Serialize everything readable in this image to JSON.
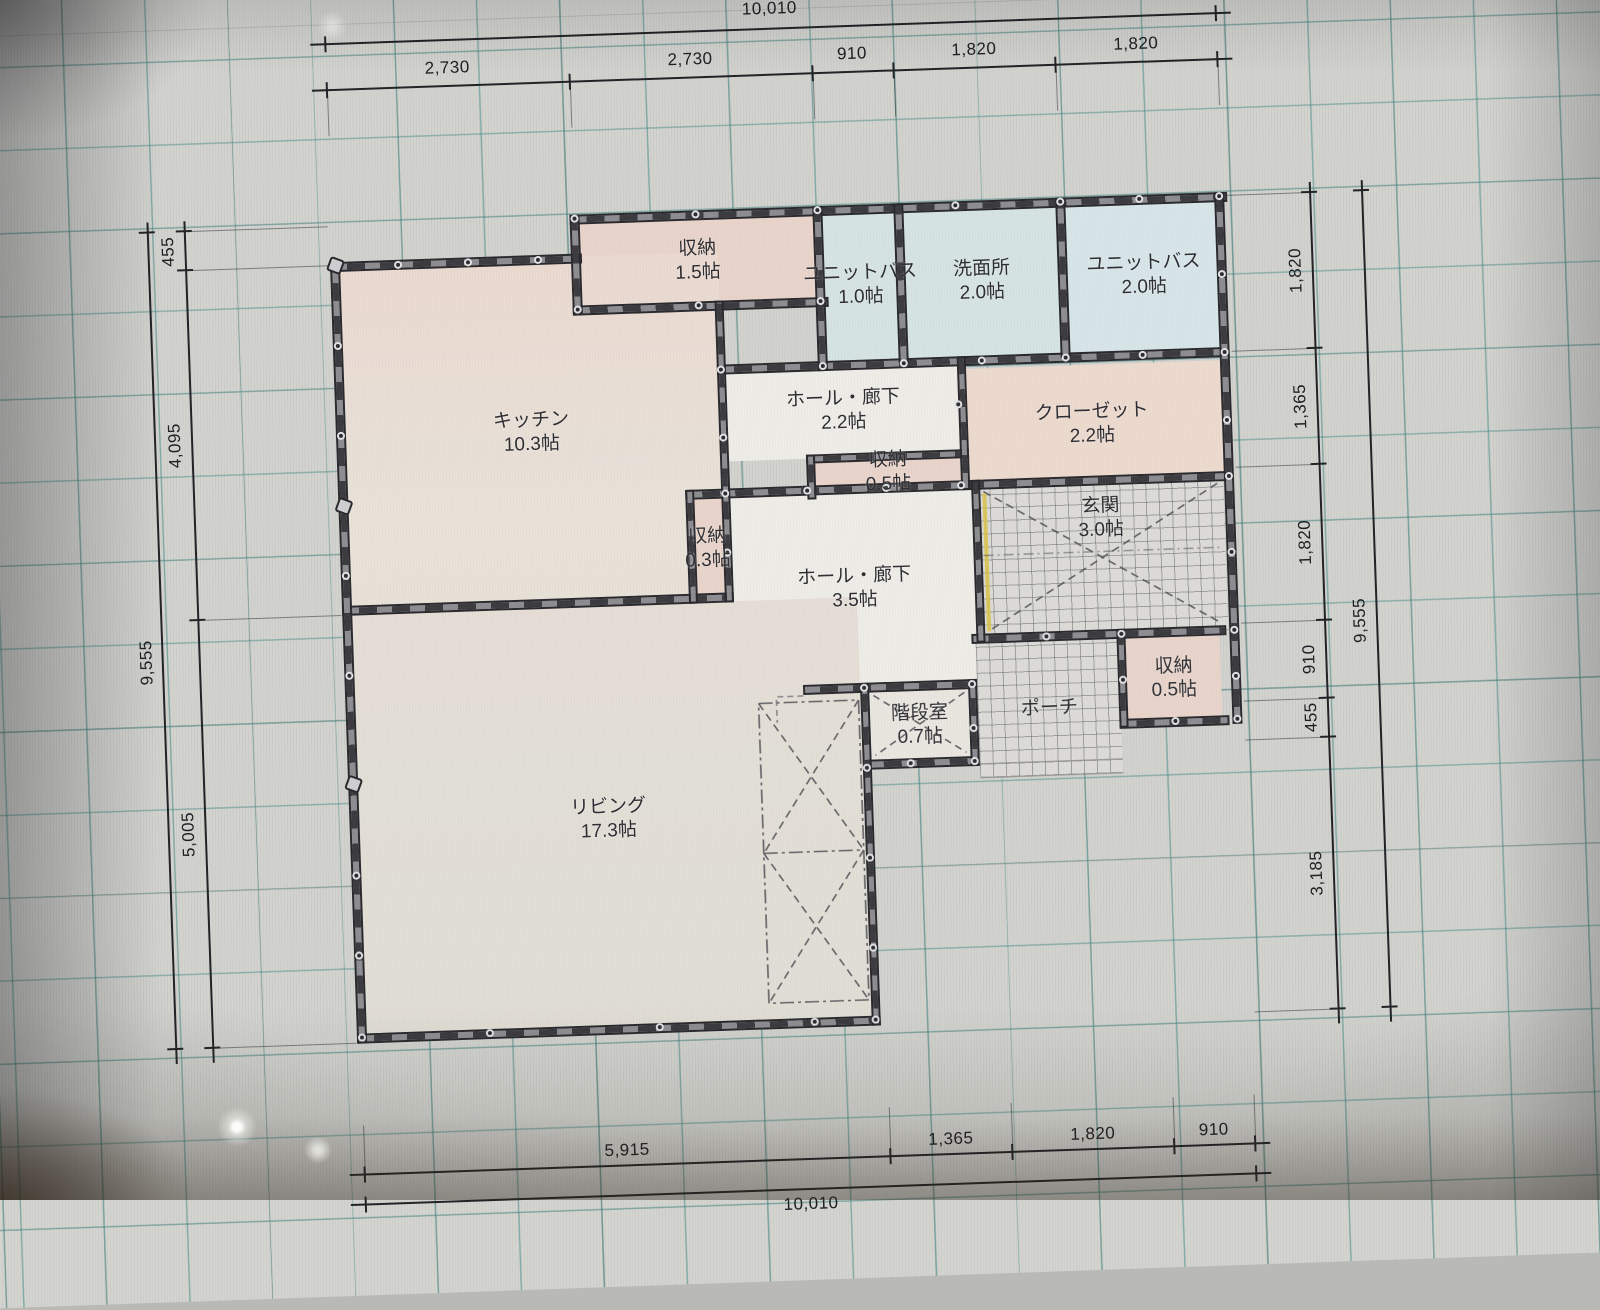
{
  "plan": {
    "title": "floor-plan-cad-canvas",
    "unit_note": "帖",
    "rooms": [
      {
        "id": "storage-1-5",
        "name": "収納",
        "size": "1.5帖"
      },
      {
        "id": "unit-bath-1-0",
        "name": "ユニットバス",
        "size": "1.0帖"
      },
      {
        "id": "washroom",
        "name": "洗面所",
        "size": "2.0帖"
      },
      {
        "id": "unit-bath-2-0",
        "name": "ユニットバス",
        "size": "2.0帖"
      },
      {
        "id": "kitchen",
        "name": "キッチン",
        "size": "10.3帖"
      },
      {
        "id": "hall-upper",
        "name": "ホール・廊下",
        "size": "2.2帖"
      },
      {
        "id": "closet",
        "name": "クローゼット",
        "size": "2.2帖"
      },
      {
        "id": "storage-0-5-top",
        "name": "収納",
        "size": "0.5帖"
      },
      {
        "id": "storage-0-3",
        "name": "収納",
        "size": "0.3帖"
      },
      {
        "id": "hall-lower",
        "name": "ホール・廊下",
        "size": "3.5帖"
      },
      {
        "id": "entrance",
        "name": "玄関",
        "size": "3.0帖"
      },
      {
        "id": "storage-0-5-right",
        "name": "収納",
        "size": "0.5帖"
      },
      {
        "id": "stairs",
        "name": "階段室",
        "size": "0.7帖"
      },
      {
        "id": "porch",
        "name": "ポーチ",
        "size": ""
      },
      {
        "id": "living",
        "name": "リビング",
        "size": "17.3帖"
      }
    ],
    "dimensions": {
      "top": {
        "total": "10,010",
        "segments": [
          "2,730",
          "2,730",
          "910",
          "1,820",
          "1,820"
        ]
      },
      "bottom": {
        "total": "10,010",
        "segments": [
          "5,915",
          "1,365",
          "1,820",
          "910"
        ]
      },
      "left": {
        "total": "9,555",
        "segments": [
          "455",
          "4,095",
          "5,005"
        ]
      },
      "right": {
        "total": "9,555",
        "segments": [
          "1,820",
          "1,365",
          "1,820",
          "910",
          "455",
          "3,185"
        ]
      }
    },
    "colors": {
      "grid_teal": "#3a847e",
      "wall_dark": "#2a2a2e",
      "room_pink": "#e8d4ca",
      "room_blue": "#d5e3e1",
      "entrance_door_accent": "#d8c24a"
    }
  }
}
